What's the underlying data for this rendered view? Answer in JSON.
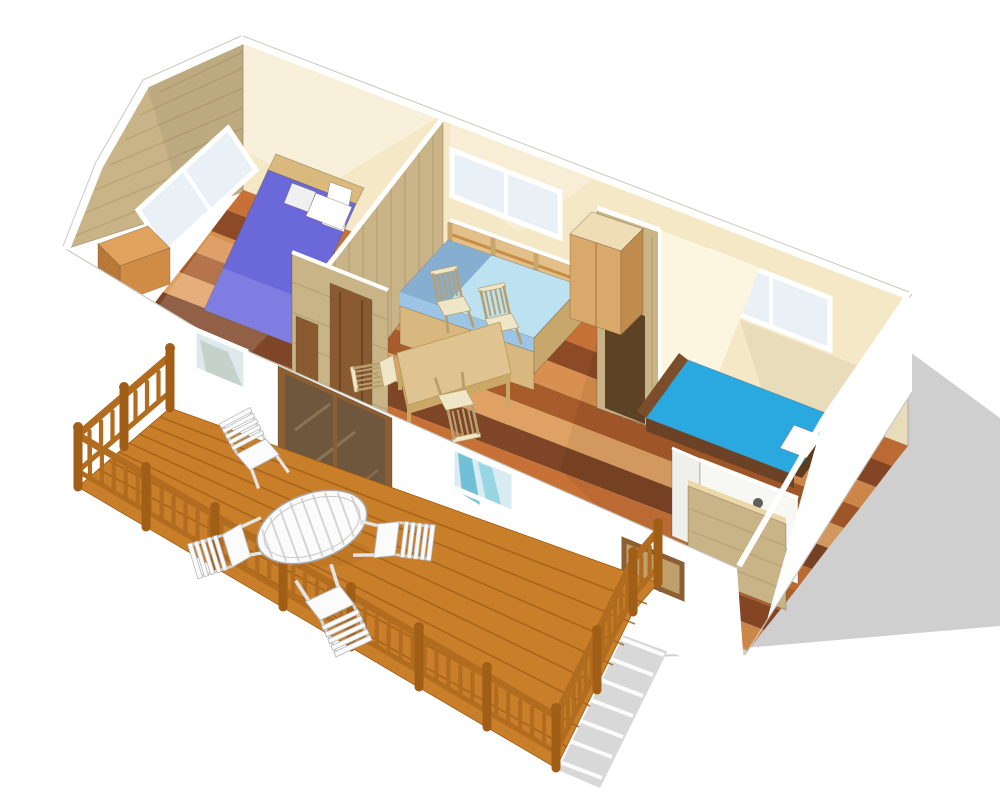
{
  "scene": {
    "type": "3d-axonometric-floorplan-cutaway-rendering",
    "subject": "mobile-home chalet with terrace deck, roof removed to show interior",
    "rooms": [
      "bedroom-left",
      "living-dining-room",
      "bedroom-right",
      "bathroom-kitchenette",
      "terrace-deck"
    ],
    "objects": {
      "bedroom-left": [
        "double-bed-purple",
        "white-pillows",
        "headboard",
        "low-cabinet",
        "gable-window"
      ],
      "living-dining-room": [
        "blue-bench-daybed",
        "slatted-wall-panels",
        "wardrobe-cabinet",
        "dining-table",
        "dining-chairs-x4",
        "back-window"
      ],
      "bedroom-right": [
        "single-bed-cyan",
        "white-pillow",
        "dark-bed-frame",
        "back-window"
      ],
      "bathroom-kitchenette": [
        "counter",
        "faucet",
        "toiletry-items",
        "wood-half-wall"
      ],
      "terrace-deck": [
        "plank-decking",
        "wood-railing-with-balusters",
        "oval-slatted-table-white",
        "patio-chairs-white-x4"
      ],
      "exterior": [
        "white-front-wall",
        "white-end-wall",
        "sliding-glass-door",
        "front-window-small-x3",
        "ground-shadow"
      ]
    }
  },
  "colors": {
    "background": "#ffffff",
    "shadow": "#cfcfcf",
    "shadow_light": "#d8d8d8",
    "wall_white": "#ffffff",
    "hairline": "#c9c9c3",
    "cream": "#f5e8c6",
    "cream_light": "#fcf5e0",
    "wood_panel": "#c9b488",
    "wood_line": "#ab9468",
    "glass": "#e9f1f6",
    "frame_white": "#ffffff",
    "f1": "#c87137",
    "f2": "#8c4a26",
    "f3": "#d98f4f",
    "f4": "#a85c2c",
    "f5": "#e0a264",
    "f6": "#7e4526",
    "f7": "#b5682f",
    "deck": "#c97f29",
    "deck_seam": "#a2601a",
    "rail": "#b26c1f",
    "rail_dark": "#a05e17",
    "bed_purple": "#6b68d9",
    "bed_purple_light": "#8a88e6",
    "headboard": "#d9b97e",
    "bed_cyan": "#2aa9e0",
    "bed_frame": "#6b4226",
    "pillow": "#ffffff",
    "bench_seat": "#bce2f2",
    "bench_seat_dark": "#7fa8cc",
    "bench_edge": "#9cc4e4",
    "bench_base": "#d9b87f",
    "slat_panel": "#e3c089",
    "slat_orange": "#c98c45",
    "slat_cream": "#f2e4c4",
    "slat_blue": "#96bede",
    "cab_top": "#efddb5",
    "cab_light": "#d9a96b",
    "cab_dark": "#c08c4e",
    "table_top": "#dfc491",
    "table_edge": "#c9a868",
    "chair": "#efe6c8",
    "chair_line": "#b89f6e",
    "door": "#8a5a30",
    "door_dark": "#5e4226",
    "doorway": "#5e4226",
    "door_glass": "#6e573c",
    "door_frame": "#8b5e34",
    "door_streak": "#93795a",
    "curtain_teal": "#5fb8d4",
    "curtain_teal2": "#8ed2e2",
    "curtain_gray": "#c2cfc9",
    "window_interior": "#bfa06a",
    "bath_wall": "#f7f7f4",
    "counter": "#8f8f8f",
    "counter_top": "#b5b5b5",
    "faucet": "#555555",
    "item_yellow": "#f2c12e",
    "item_red": "#d93a2b",
    "item_blue": "#4a86d8",
    "white_furn": "#fbfbfb",
    "furn_line": "#a8a8a8",
    "furn_slat": "#d5d5d5"
  }
}
